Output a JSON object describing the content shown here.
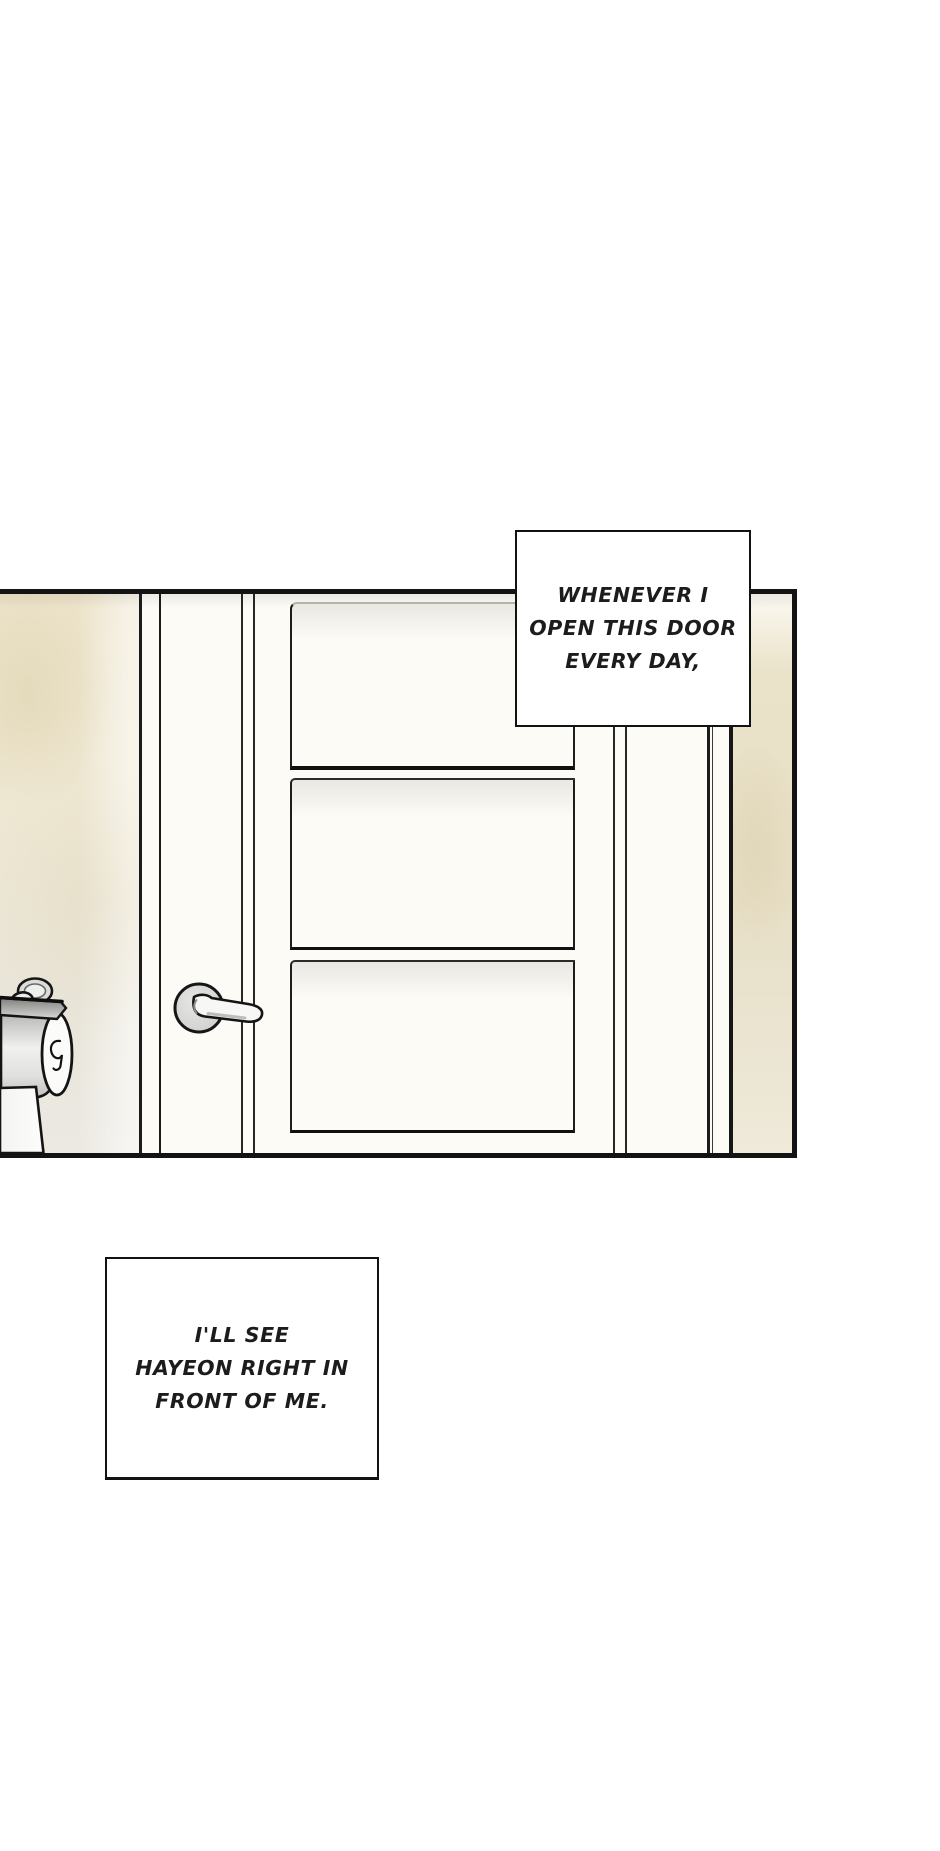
{
  "page": {
    "width": 940,
    "height": 1851,
    "background": "#ffffff"
  },
  "colors": {
    "ink": "#131313",
    "wall_beige": "#ebe3c9",
    "door_white": "#fcfbf6",
    "metal_gray": "#cfcfcd",
    "caption_text": "#1c1c1c"
  },
  "captions": {
    "top": {
      "lines": [
        "WHENEVER I",
        "OPEN THIS DOOR",
        "EVERY DAY,"
      ]
    },
    "bottom": {
      "lines": [
        "I'LL SEE",
        "HAYEON RIGHT IN",
        "FRONT OF ME."
      ]
    }
  }
}
